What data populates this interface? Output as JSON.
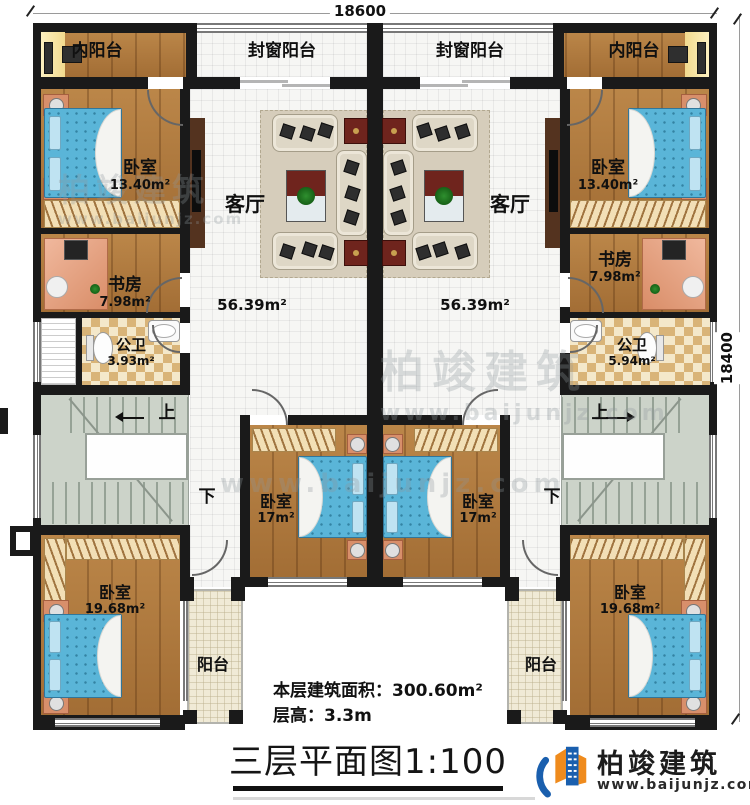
{
  "dimensions": {
    "top": "18600",
    "right": "18400"
  },
  "units": {
    "left": {
      "inner_balcony": "内阳台",
      "sealed_balcony": "封窗阳台",
      "bedroom_top": {
        "name": "卧室",
        "area": "13.40m²"
      },
      "living": {
        "name": "客厅",
        "area": "56.39m²"
      },
      "study": {
        "name": "书房",
        "area": "7.98m²"
      },
      "bath": {
        "name": "公卫",
        "area": "3.93m²"
      },
      "stair_up": "上",
      "stair_down": "下",
      "bedroom_mid": {
        "name": "卧室",
        "area": "17m²"
      },
      "bedroom_bottom": {
        "name": "卧室",
        "area": "19.68m²"
      },
      "balcony": "阳台"
    },
    "right": {
      "inner_balcony": "内阳台",
      "sealed_balcony": "封窗阳台",
      "bedroom_top": {
        "name": "卧室",
        "area": "13.40m²"
      },
      "living": {
        "name": "客厅",
        "area": "56.39m²"
      },
      "study": {
        "name": "书房",
        "area": "7.98m²"
      },
      "bath": {
        "name": "公卫",
        "area": "5.94m²"
      },
      "stair_up": "上",
      "stair_down": "下",
      "bedroom_mid": {
        "name": "卧室",
        "area": "17m²"
      },
      "bedroom_bottom": {
        "name": "卧室",
        "area": "19.68m²"
      },
      "balcony": "阳台"
    }
  },
  "footer": {
    "floor_area_label": "本层建筑面积：",
    "floor_area_value": "300.60m²",
    "floor_height_label": "层高：",
    "floor_height_value": "3.3m",
    "title": "三层平面图1:100"
  },
  "brand": {
    "name": "柏竣建筑",
    "website": "www.baijunjz.com"
  },
  "watermark": {
    "name": "柏竣建筑",
    "website": "www.baijunjz.com"
  },
  "colors": {
    "wall": "#1a1a1a",
    "wood_floor": "#b0793c",
    "tile_floor": "#f6f6f4",
    "stair_floor": "#ccd3c9",
    "bed_blue": "#5ab5d8",
    "accent_red": "#6f241d",
    "brand_blue": "#1a5fae",
    "brand_orange": "#ef8b1d"
  }
}
